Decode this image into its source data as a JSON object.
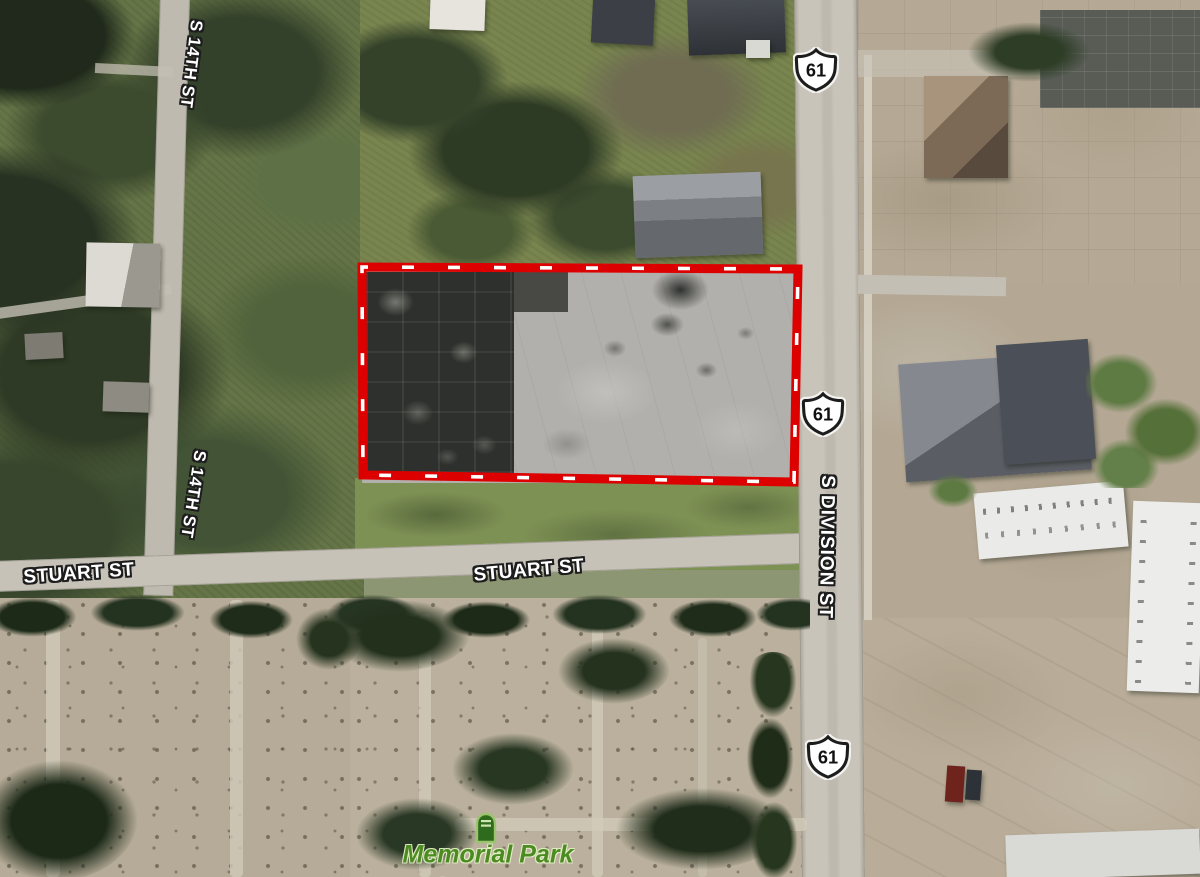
{
  "map": {
    "type": "aerial-satellite-view",
    "streets": {
      "s14th_upper": "S 14TH ST",
      "s14th_lower": "S 14TH ST",
      "stuart_west": "STUART ST",
      "stuart_east": "STUART ST",
      "s_division": "S DIVISION ST"
    },
    "route_shields": [
      {
        "icon": "us-route-shield-icon",
        "route": "61"
      },
      {
        "icon": "us-route-shield-icon",
        "route": "61"
      },
      {
        "icon": "us-route-shield-icon",
        "route": "61"
      }
    ],
    "poi": {
      "cemetery": {
        "icon": "tombstone-icon",
        "name_line1": "Memorial Park",
        "name_line2": "Cemetery",
        "label_color": "#4c8a22"
      }
    },
    "parcel_highlight": {
      "shape": "rectangle",
      "stroke_color": "#dd0000",
      "dash_color": "#ffffff",
      "style": "red-band-with-white-dashes"
    },
    "colors": {
      "road": "#c6c1b7",
      "grass": "#79854f",
      "dirt_tan": "#b6ab98",
      "tree_dark": "#243220",
      "parcel_concrete": "#b2b0ac",
      "parcel_charred": "#2d302c",
      "street_label_fill": "#ffffff",
      "street_label_outline": "#1d1d1d"
    }
  }
}
